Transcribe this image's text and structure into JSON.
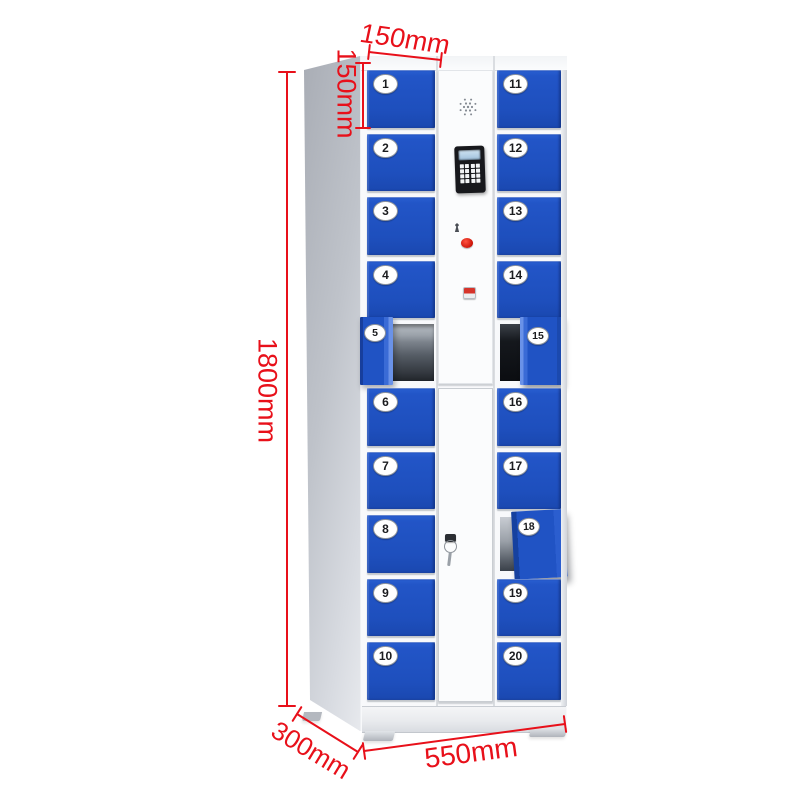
{
  "image_type": "product-dimension-diagram",
  "product_name": "smart-electronic-locker-cabinet-20-door",
  "lockers": {
    "left": [
      {
        "no": "1",
        "state": "closed"
      },
      {
        "no": "2",
        "state": "closed"
      },
      {
        "no": "3",
        "state": "closed"
      },
      {
        "no": "4",
        "state": "closed"
      },
      {
        "no": "5",
        "state": "open"
      },
      {
        "no": "6",
        "state": "closed"
      },
      {
        "no": "7",
        "state": "closed"
      },
      {
        "no": "8",
        "state": "closed"
      },
      {
        "no": "9",
        "state": "closed"
      },
      {
        "no": "10",
        "state": "closed"
      }
    ],
    "right": [
      {
        "no": "11",
        "state": "closed"
      },
      {
        "no": "12",
        "state": "closed"
      },
      {
        "no": "13",
        "state": "closed"
      },
      {
        "no": "14",
        "state": "closed"
      },
      {
        "no": "15",
        "state": "open"
      },
      {
        "no": "16",
        "state": "closed"
      },
      {
        "no": "17",
        "state": "closed"
      },
      {
        "no": "18",
        "state": "ajar"
      },
      {
        "no": "19",
        "state": "closed"
      },
      {
        "no": "20",
        "state": "closed"
      }
    ]
  },
  "control_panel": {
    "speaker": "speaker-grille",
    "display": "lcd-screen",
    "keypad_rows": 4,
    "keypad_cols": 4,
    "indicator_light_color": "#cc1408",
    "has_keyhole": true,
    "has_power_button": true
  },
  "key": {
    "present": true,
    "location": "lower-center-door"
  },
  "dimensions": {
    "top_width": "150mm",
    "single_door_height": "150mm",
    "overall_height": "1800mm",
    "depth": "300mm",
    "overall_width": "550mm"
  },
  "colors": {
    "door_blue": "#2155c5",
    "annotation_red": "#e8101a",
    "cabinet_body": "#f8f9fb",
    "side_panel_gray": "#c4c8cf"
  }
}
